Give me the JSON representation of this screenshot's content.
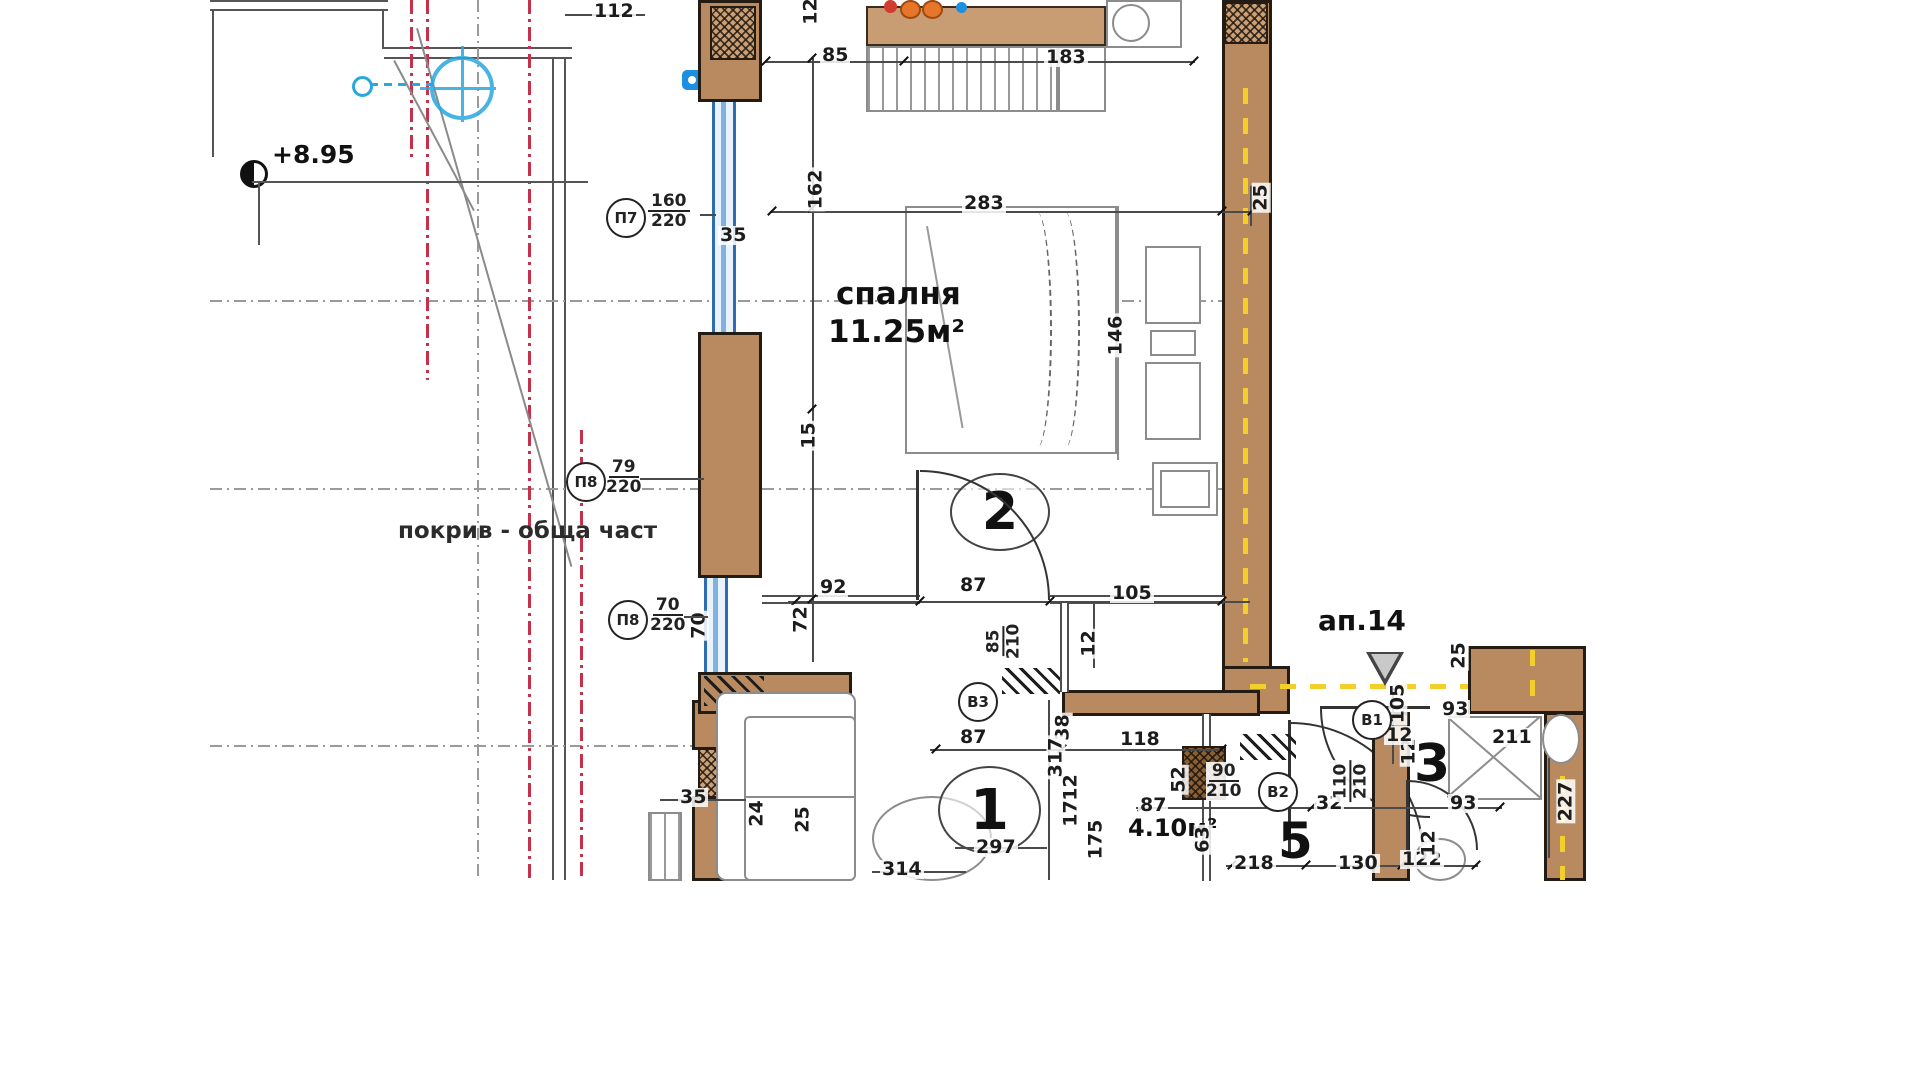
{
  "drawing": {
    "type": "architectural floor plan",
    "apartment_label": "ап.14",
    "level_mark": "+8.95",
    "roof_note": "покрив - обща част"
  },
  "rooms": {
    "bedroom": {
      "number": "2",
      "name": "спалня",
      "area": "11.25м²"
    },
    "living": {
      "number": "1"
    },
    "hall": {
      "number": "5",
      "area": "4.10м²"
    },
    "bath": {
      "number": "3"
    }
  },
  "window_tags": [
    {
      "id": "П7",
      "size": "160/220",
      "cx": 606,
      "cy": 198,
      "fx": 648,
      "fy": 192,
      "lx": 700,
      "ly": 214,
      "lw": 16
    },
    {
      "id": "П8",
      "size": "79/220",
      "cx": 566,
      "cy": 462,
      "fx": 606,
      "fy": 458,
      "lx": 640,
      "ly": 478,
      "lw": 64
    },
    {
      "id": "П8",
      "size": "70/220",
      "cx": 608,
      "cy": 600,
      "fx": 650,
      "fy": 596,
      "lx": 684,
      "ly": 616,
      "lw": 24
    }
  ],
  "door_tags": [
    {
      "id": "В3",
      "size": "85/210",
      "cx": 958,
      "cy": 682,
      "fx": 986,
      "fy": 622,
      "rot": true
    },
    {
      "id": "В2",
      "size": "90/210",
      "cx": 1258,
      "cy": 772,
      "fx": 1206,
      "fy": 762,
      "rot": false
    },
    {
      "id": "В1",
      "size": "110/210",
      "cx": 1352,
      "cy": 700,
      "fx": 1330,
      "fy": 762,
      "rot": true
    }
  ],
  "dims": [
    {
      "t": "112",
      "x": 592,
      "y": 2
    },
    {
      "t": "12",
      "x": 796,
      "y": 2,
      "r": 1
    },
    {
      "t": "85",
      "x": 820,
      "y": 46
    },
    {
      "t": "183",
      "x": 1044,
      "y": 48
    },
    {
      "t": "162",
      "x": 794,
      "y": 180,
      "r": 1
    },
    {
      "t": "35",
      "x": 718,
      "y": 226
    },
    {
      "t": "283",
      "x": 962,
      "y": 194
    },
    {
      "t": "25",
      "x": 1246,
      "y": 188,
      "r": 1
    },
    {
      "t": "146",
      "x": 1094,
      "y": 326,
      "r": 1
    },
    {
      "t": "15",
      "x": 794,
      "y": 426,
      "r": 1
    },
    {
      "t": "92",
      "x": 818,
      "y": 578
    },
    {
      "t": "87",
      "x": 958,
      "y": 576
    },
    {
      "t": "105",
      "x": 1110,
      "y": 584
    },
    {
      "t": "72",
      "x": 786,
      "y": 610,
      "r": 1
    },
    {
      "t": "12",
      "x": 1074,
      "y": 634,
      "r": 1
    },
    {
      "t": "70",
      "x": 684,
      "y": 616,
      "r": 1
    },
    {
      "t": "87",
      "x": 958,
      "y": 728
    },
    {
      "t": "118",
      "x": 1118,
      "y": 730
    },
    {
      "t": "38",
      "x": 1048,
      "y": 718,
      "r": 1
    },
    {
      "t": "317",
      "x": 1034,
      "y": 748,
      "r": 1
    },
    {
      "t": "12",
      "x": 1056,
      "y": 778,
      "r": 1
    },
    {
      "t": "17",
      "x": 1056,
      "y": 804,
      "r": 1
    },
    {
      "t": "175",
      "x": 1074,
      "y": 830,
      "r": 1
    },
    {
      "t": "52",
      "x": 1164,
      "y": 770,
      "r": 1
    },
    {
      "t": "297",
      "x": 974,
      "y": 838
    },
    {
      "t": "314",
      "x": 880,
      "y": 860
    },
    {
      "t": "35",
      "x": 678,
      "y": 788
    },
    {
      "t": "24",
      "x": 742,
      "y": 804,
      "r": 1
    },
    {
      "t": "25",
      "x": 788,
      "y": 810,
      "r": 1
    },
    {
      "t": "218",
      "x": 1232,
      "y": 854
    },
    {
      "t": "130",
      "x": 1336,
      "y": 854
    },
    {
      "t": "122",
      "x": 1400,
      "y": 850
    },
    {
      "t": "87",
      "x": 1138,
      "y": 796
    },
    {
      "t": "32",
      "x": 1314,
      "y": 794
    },
    {
      "t": "93",
      "x": 1448,
      "y": 794
    },
    {
      "t": "63",
      "x": 1188,
      "y": 830,
      "r": 1
    },
    {
      "t": "12",
      "x": 1414,
      "y": 834,
      "r": 1
    },
    {
      "t": "93",
      "x": 1440,
      "y": 700
    },
    {
      "t": "105",
      "x": 1376,
      "y": 694,
      "r": 1
    },
    {
      "t": "12",
      "x": 1394,
      "y": 742,
      "r": 1
    },
    {
      "t": "227",
      "x": 1544,
      "y": 792,
      "r": 1
    },
    {
      "t": "211",
      "x": 1490,
      "y": 728
    },
    {
      "t": "25",
      "x": 1444,
      "y": 646,
      "r": 1
    },
    {
      "t": "12",
      "x": 1384,
      "y": 726
    }
  ],
  "colors": {
    "wall_fill": "#b98a5f",
    "wall_outline": "#241b12",
    "window_blue": "#2f6db3",
    "boundary_yellow": "#f2cf2a",
    "roof_edge_red": "#c5304a",
    "survey_cyan": "#29a8e0",
    "grid_grey": "#9a9a9a"
  }
}
